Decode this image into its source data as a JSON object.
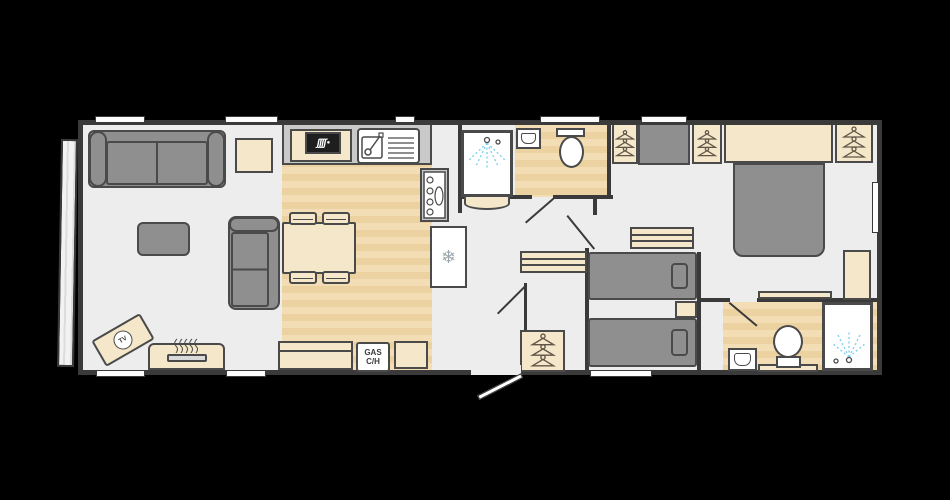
{
  "scene": {
    "type": "holiday-home floor plan, side entrance, lounge left / master bedroom right"
  },
  "labels": {
    "tv": "TV",
    "gas_line1": "GAS",
    "gas_line2": "C/H"
  },
  "glyphs": {
    "fridge_snowflake": "❄",
    "hob_burners": "ʃʃʃʃ"
  },
  "colors": {
    "bg": "#000000",
    "wall": "#3a3a3a",
    "floor": "#ededed",
    "wood-a": "#f3ddb4",
    "wood-b": "#ecd1a1",
    "grey": "#8f8f8f",
    "outline": "#4a4a4a",
    "beige": "#f5e7c9",
    "worktop": "#c9c9c9",
    "white": "#ffffff",
    "spray": "#7fd2f0",
    "hanger": "#5f5647",
    "glass": "#fdfdfd"
  },
  "rooms": {
    "lounge": {
      "furniture": [
        "sofa",
        "loveseat",
        "coffee-table",
        "side-table",
        "tv-unit",
        "fireplace"
      ]
    },
    "kitchen": {
      "furniture": [
        "worktop",
        "hob",
        "sink-drainer",
        "cooker",
        "fridge-freezer",
        "dining-table",
        "4 stools",
        "bench",
        "gas-central-heating-unit",
        "cabinet"
      ]
    },
    "shower_room": {
      "furniture": [
        "shower-cubicle",
        "wash-basin",
        "toilet"
      ]
    },
    "hallway": {
      "furniture": [
        "wardrobe",
        "sideboard",
        "entrance-door"
      ]
    },
    "twin_bedroom": {
      "furniture": [
        "wardrobe",
        "cupboard",
        "wardrobe",
        "chest-of-drawers",
        "single-bed",
        "single-bed",
        "bedside-table"
      ]
    },
    "master_bedroom": {
      "furniture": [
        "headboard-unit",
        "wardrobe",
        "wardrobe",
        "double-bed",
        "bedside-unit",
        "shelf"
      ]
    },
    "ensuite": {
      "furniture": [
        "wash-basin",
        "toilet",
        "shelf",
        "shower-cubicle"
      ]
    }
  },
  "openings": {
    "windows_top_wall": 5,
    "windows_bottom_wall": 3,
    "windows_right_wall": 1,
    "entrance_door": "bottom centre, opens outward",
    "internal_doors": 4,
    "front_panel": "full-height glazing, left end"
  }
}
